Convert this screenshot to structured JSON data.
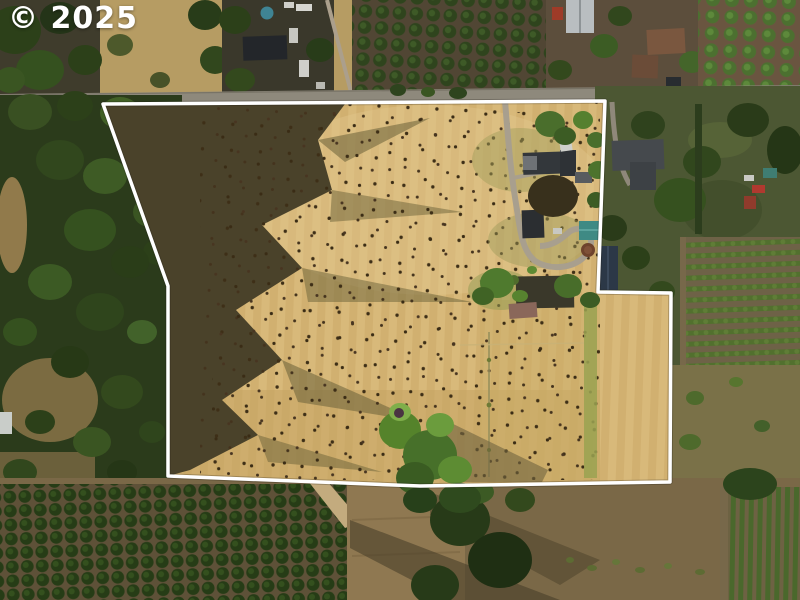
{
  "watermark": {
    "text": "© 2025"
  },
  "scene": {
    "type": "aerial-property-photo",
    "boundary": {
      "color": "#ffffff",
      "points": "103,104 605,101 598,292 671,293 670,482 420,486 168,476 168,286"
    },
    "palette": {
      "field": "#d4b476",
      "forest": "#2b3b1b",
      "road": "#8e897c",
      "south_pasture": "#7a6847",
      "lawn_east": "#4c5733",
      "watermark": "#ffffff"
    }
  }
}
